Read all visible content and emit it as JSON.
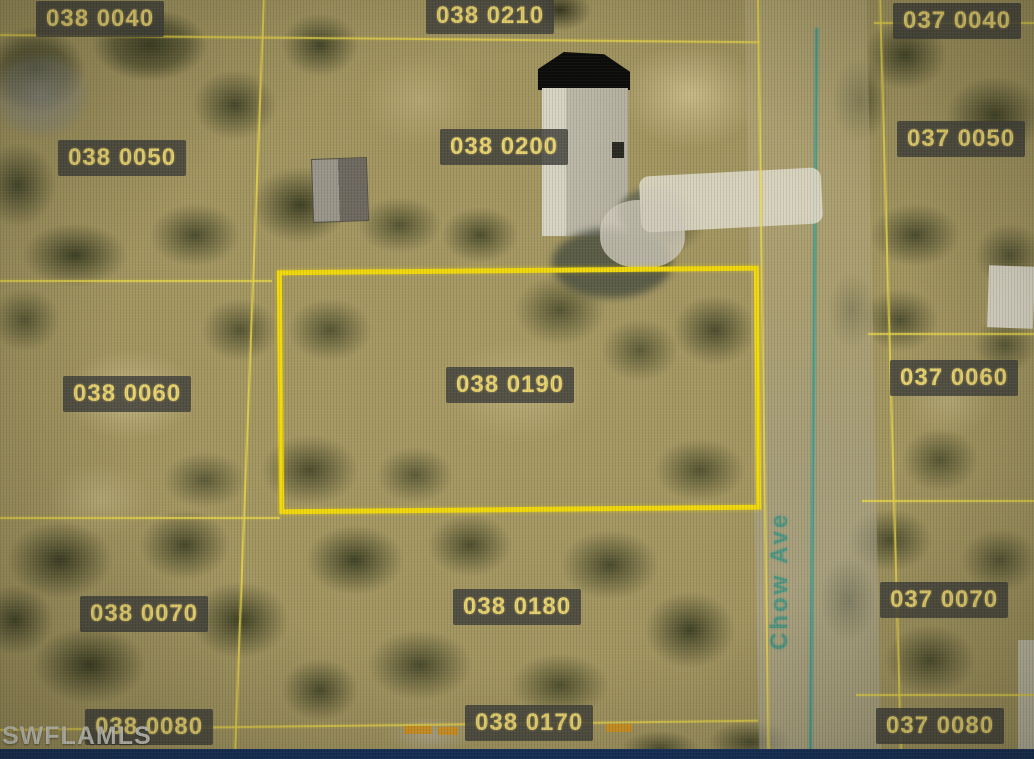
{
  "map": {
    "type": "aerial-parcel-map",
    "watermark": "SWFLAMLS",
    "street": {
      "label": "Chow Ave"
    },
    "highlighted_parcel_id": "038 0190",
    "parcels": [
      {
        "id": "038 0040",
        "highlighted": false
      },
      {
        "id": "038 0210",
        "highlighted": false
      },
      {
        "id": "037 0040",
        "highlighted": false
      },
      {
        "id": "038 0050",
        "highlighted": false
      },
      {
        "id": "038 0200",
        "highlighted": false
      },
      {
        "id": "037 0050",
        "highlighted": false
      },
      {
        "id": "038 0060",
        "highlighted": false
      },
      {
        "id": "038 0190",
        "highlighted": true
      },
      {
        "id": "037 0060",
        "highlighted": false
      },
      {
        "id": "038 0070",
        "highlighted": false
      },
      {
        "id": "038 0180",
        "highlighted": false
      },
      {
        "id": "037 0070",
        "highlighted": false
      },
      {
        "id": "038 0080",
        "highlighted": false
      },
      {
        "id": "038 0170",
        "highlighted": false
      },
      {
        "id": "037 0080",
        "highlighted": false
      }
    ],
    "colors": {
      "boundary_line": "#ebd74a",
      "highlight_border": "#f2d90c",
      "label_text": "#e9d36e",
      "label_background": "#42423c",
      "street_text": "#3e9484",
      "marker_dash": "#d4921e",
      "frame_strip": "#16315c"
    }
  }
}
